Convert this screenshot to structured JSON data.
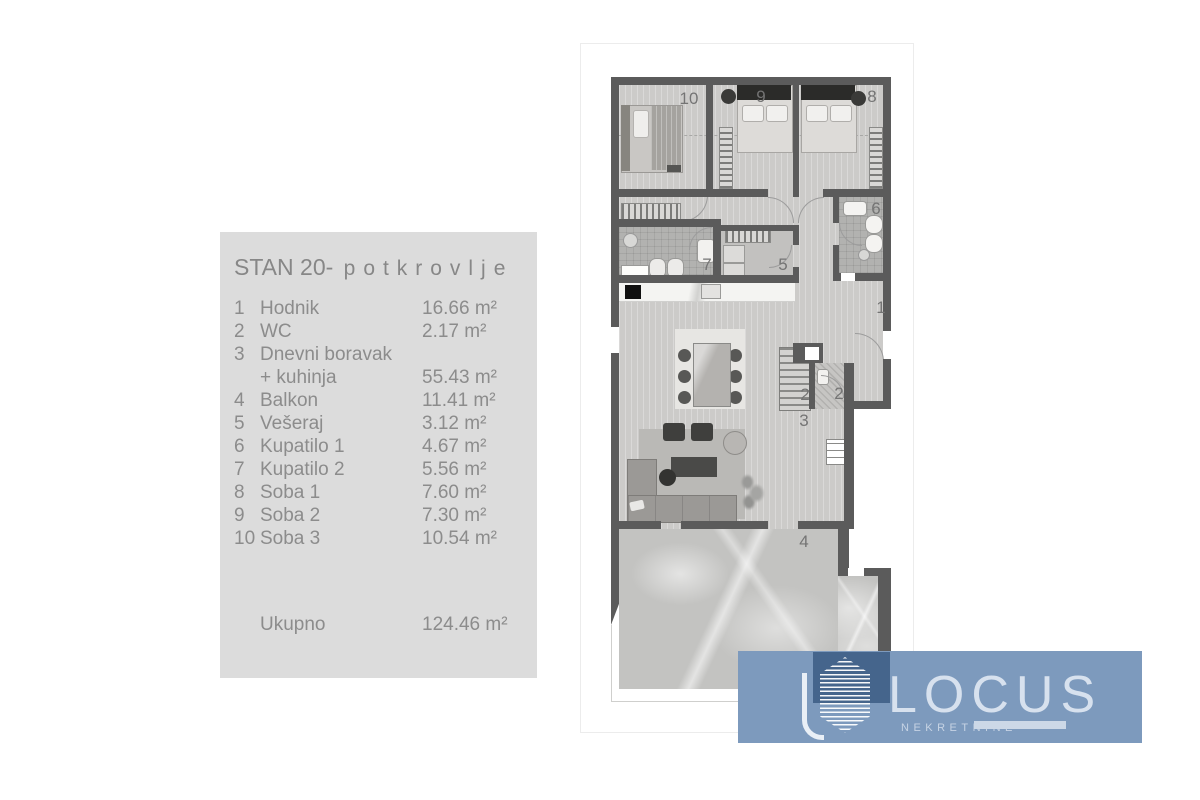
{
  "panel": {
    "title": "STAN 20",
    "separator": "-",
    "subtitle": "potkrovlje",
    "rows": [
      {
        "num": "1",
        "name": "Hodnik",
        "area": "16.66 m²"
      },
      {
        "num": "2",
        "name": "WC",
        "area": "2.17 m²"
      },
      {
        "num": "3",
        "name": "Dnevni boravak",
        "area": ""
      },
      {
        "num": "",
        "name": "+ kuhinja",
        "area": "55.43 m²"
      },
      {
        "num": "4",
        "name": "Balkon",
        "area": "11.41 m²"
      },
      {
        "num": "5",
        "name": "Vešeraj",
        "area": "3.12 m²"
      },
      {
        "num": "6",
        "name": "Kupatilo 1",
        "area": "4.67 m²"
      },
      {
        "num": "7",
        "name": "Kupatilo 2",
        "area": "5.56 m²"
      },
      {
        "num": "8",
        "name": "Soba 1",
        "area": "7.60 m²"
      },
      {
        "num": "9",
        "name": "Soba 2",
        "area": "7.30 m²"
      },
      {
        "num": "10",
        "name": "Soba 3",
        "area": "10.54 m²"
      }
    ],
    "total_label": "Ukupno",
    "total_area": "124.46 m²"
  },
  "plan": {
    "labels": {
      "soba3": "10",
      "soba2": "9",
      "soba1": "8",
      "kupatilo1": "6",
      "kupatilo2": "7",
      "veseraj": "5",
      "hodnik": "1",
      "wc_a": "2",
      "wc_b": "2",
      "dnevni": "3",
      "balkon": "4"
    }
  },
  "logo": {
    "name": "LOCUS",
    "subtitle": "NEKRETNINE",
    "brand_blue": "#7d9abd",
    "brand_navy": "#45658c"
  }
}
